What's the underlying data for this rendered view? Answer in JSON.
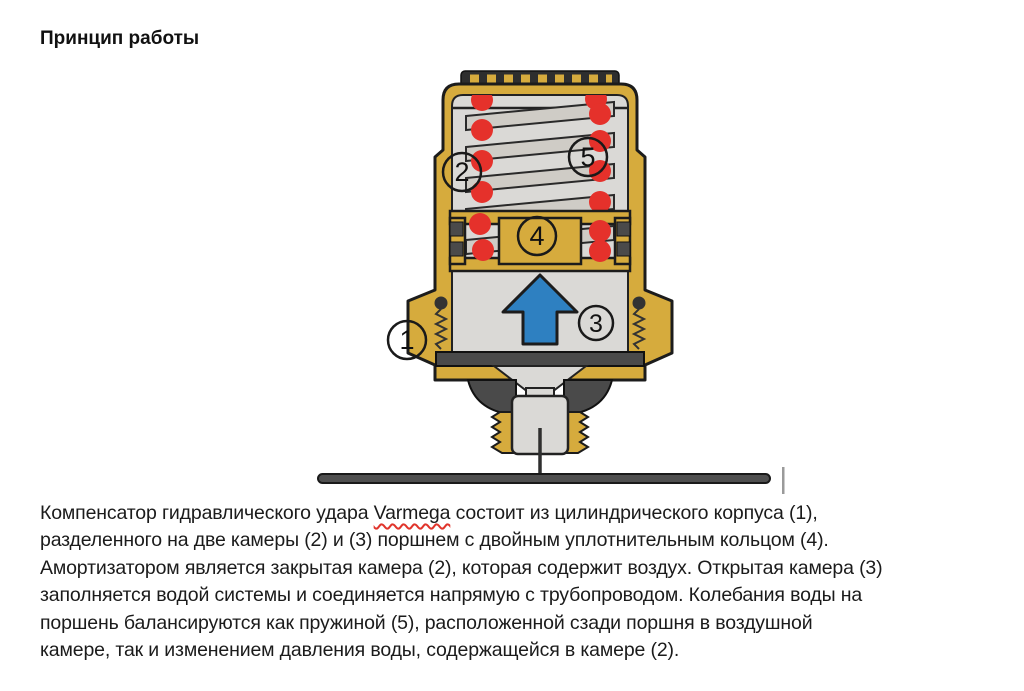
{
  "heading": "Принцип работы",
  "paragraph": {
    "line1_pre": "Компенсатор гидравлического удара ",
    "line1_word": "Varmega",
    "line1_post": " состоит из цилиндрического корпуса (1),",
    "lines": [
      "разделенного на две камеры (2) и (3) поршнем с двойным уплотнительным кольцом (4).",
      "Амортизатором является закрытая камера (2), которая содержит воздух. Открытая камера (3)",
      "заполняется водой системы и соединяется напрямую с трубопроводом. Колебания воды на",
      "поршень балансируются как пружиной (5), расположенной сзади поршня в воздушной",
      "камере, так и изменением давления воды, содержащейся в камере (2)."
    ]
  },
  "diagram": {
    "subject": "Компенсатор гидравлического удара Varmega — разрез",
    "callouts": {
      "c1": "1",
      "c2": "2",
      "c3": "3",
      "c4": "4",
      "c5": "5"
    },
    "colors": {
      "brass": "#d6ab3d",
      "chamber_gray": "#dad9d6",
      "spring_gray": "#cfccc6",
      "oring_red": "#e5312b",
      "seal_dark": "#4a4a4a",
      "arrow_blue": "#2e80c1",
      "outline": "#1c1c1c"
    }
  }
}
